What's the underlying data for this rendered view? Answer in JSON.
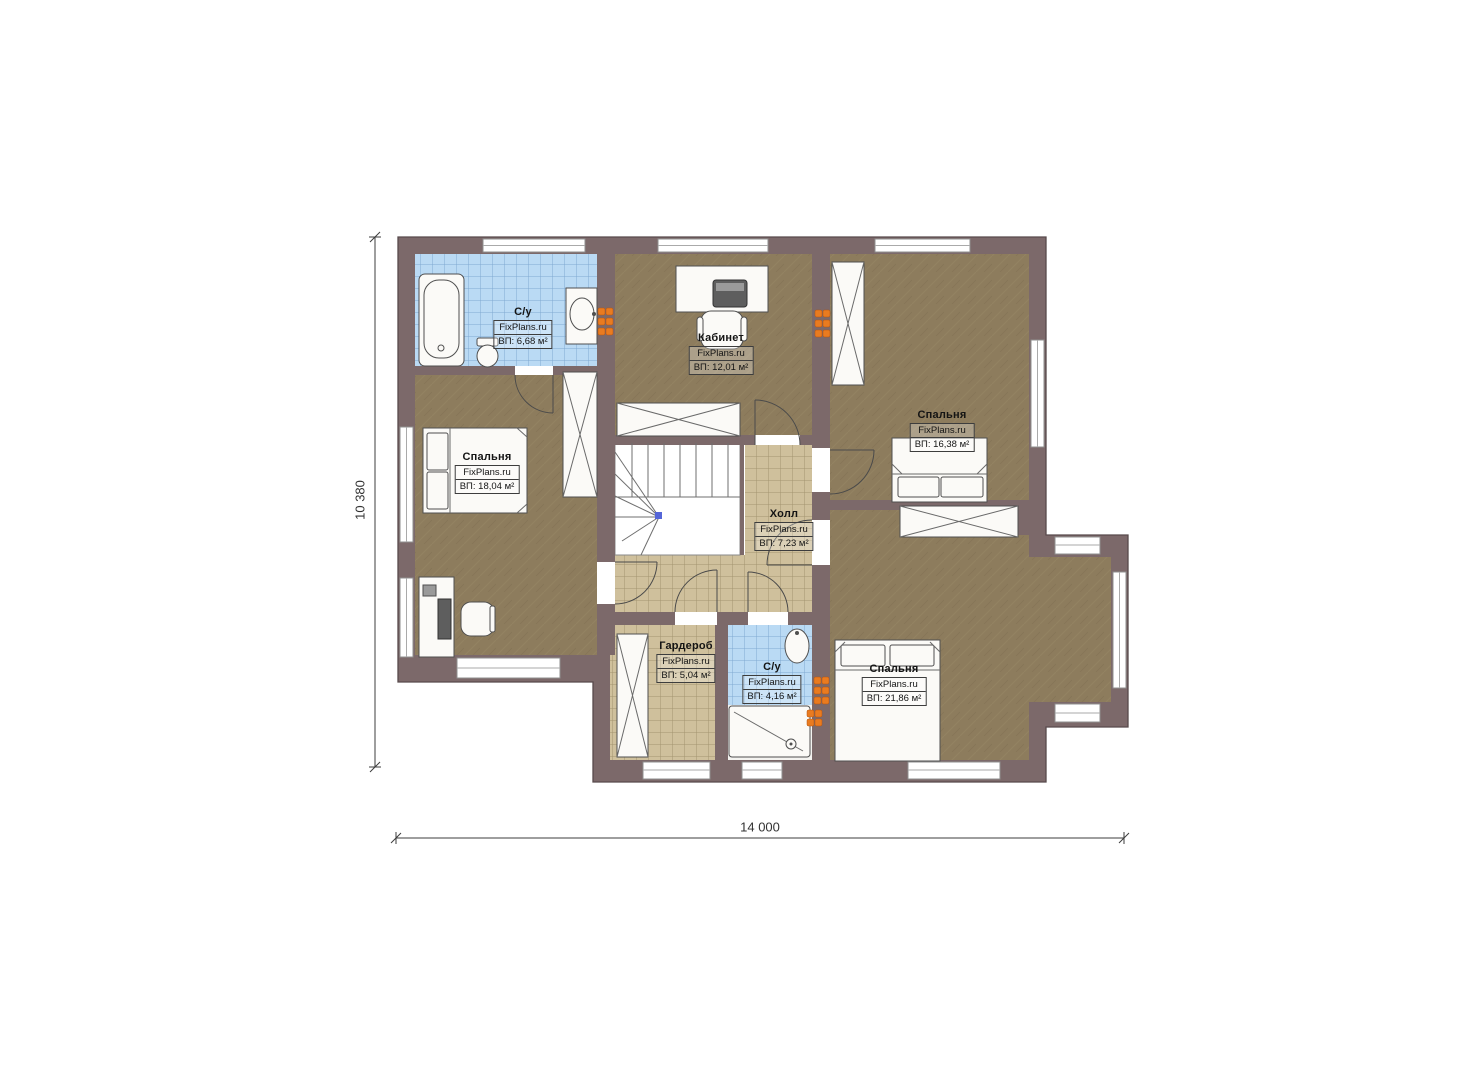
{
  "plan": {
    "watermark": "FixPlans.ru",
    "rooms": [
      {
        "id": "bathroom-top-left",
        "name": "С/у",
        "area_label": "ВП: 6,68 м²"
      },
      {
        "id": "office",
        "name": "Кабинет",
        "area_label": "ВП: 12,01 м²"
      },
      {
        "id": "bedroom-top-right",
        "name": "Спальня",
        "area_label": "ВП: 16,38 м²"
      },
      {
        "id": "bedroom-left",
        "name": "Спальня",
        "area_label": "ВП: 18,04 м²"
      },
      {
        "id": "hall",
        "name": "Холл",
        "area_label": "ВП: 7,23 м²"
      },
      {
        "id": "wardrobe-room",
        "name": "Гардероб",
        "area_label": "ВП: 5,04 м²"
      },
      {
        "id": "bathroom-bottom",
        "name": "С/у",
        "area_label": "ВП: 4,16 м²"
      },
      {
        "id": "bedroom-bottom-right",
        "name": "Спальня",
        "area_label": "ВП: 21,86 м²"
      }
    ],
    "dimensions": {
      "overall_width_mm": "14 000",
      "overall_depth_mm": "10 380"
    },
    "colors": {
      "wall": "#7c696a",
      "wall_outline": "#584a4c",
      "wood_floor": "#8d7c5d",
      "tile_beige": "#cfc09c",
      "tile_blue": "#badaf4",
      "vent_orange": "#e97b20",
      "dimension_line": "#3c3c3c"
    }
  }
}
